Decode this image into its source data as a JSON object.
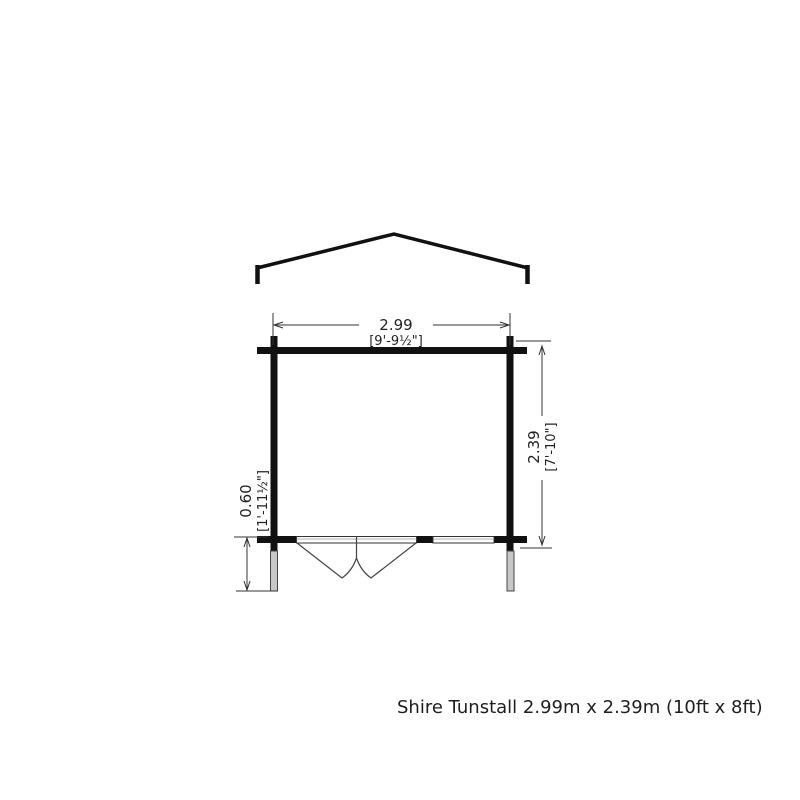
{
  "page": {
    "background": "#ffffff"
  },
  "caption": {
    "text": "Shire Tunstall 2.99m x 2.39m (10ft x 8ft)"
  },
  "dimensions": {
    "width": {
      "metric": "2.99",
      "imperial": "[9'-9½\"]"
    },
    "depth": {
      "metric": "2.39",
      "imperial": "[7'-10\"]"
    },
    "canopy_depth": {
      "metric": "0.60",
      "imperial": "[1'-11½\"]"
    }
  },
  "drawing": {
    "kind": "log-cabin floor plan with gable roof outline",
    "features": [
      "gable-roof-outline",
      "interlocking-corner-joints",
      "double-door-swing",
      "window",
      "front-canopy-posts"
    ]
  },
  "colors": {
    "wall_line": "#111111",
    "dimension_line": "#333333",
    "post_fill": "#c8c8c8",
    "caption_text": "#1e1e1e"
  }
}
